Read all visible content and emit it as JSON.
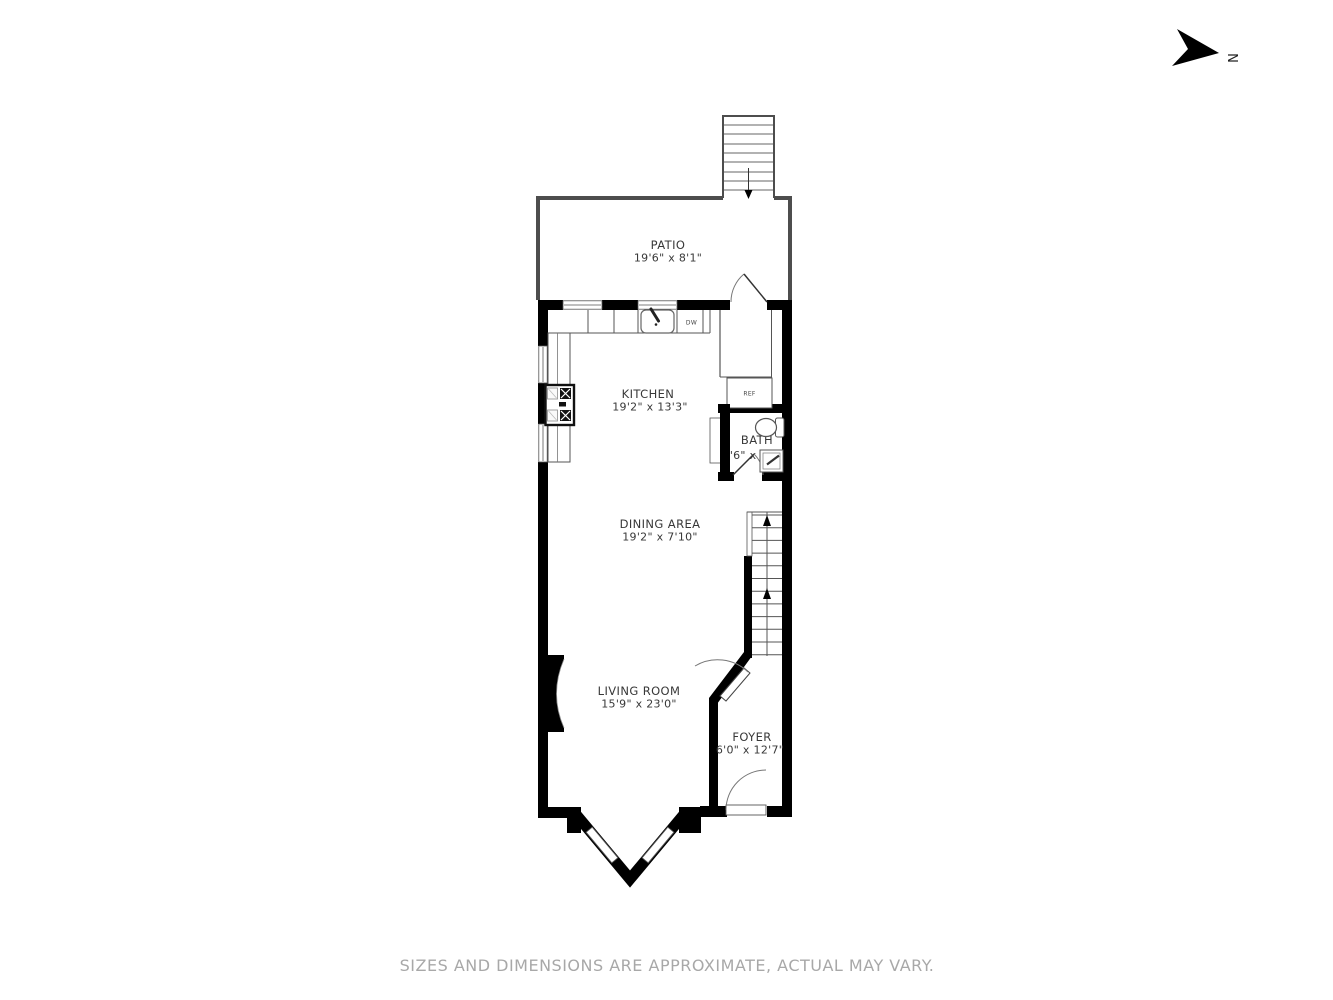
{
  "compass": {
    "north_label": "N"
  },
  "rooms": {
    "patio": {
      "name": "PATIO",
      "dims": "19'6\" x 8'1\""
    },
    "kitchen": {
      "name": "KITCHEN",
      "dims": "19'2\" x 13'3\""
    },
    "bath": {
      "name": "BATH",
      "dims": "7'6\" x 5'0\""
    },
    "dining": {
      "name": "DINING AREA",
      "dims": "19'2\" x 7'10\""
    },
    "living": {
      "name": "LIVING ROOM",
      "dims": "15'9\" x 23'0\""
    },
    "foyer": {
      "name": "FOYER",
      "dims": "6'0\" x 12'7\""
    }
  },
  "appliances": {
    "refrigerator": "REF",
    "dishwasher": "DW"
  },
  "footer": {
    "disclaimer": "SIZES AND DIMENSIONS ARE APPROXIMATE, ACTUAL MAY VARY."
  },
  "colors": {
    "wall": "#000000",
    "thin_line": "#4d4d4d",
    "label_text": "#383838",
    "footer_text": "#a8a8a8",
    "background": "#ffffff"
  }
}
